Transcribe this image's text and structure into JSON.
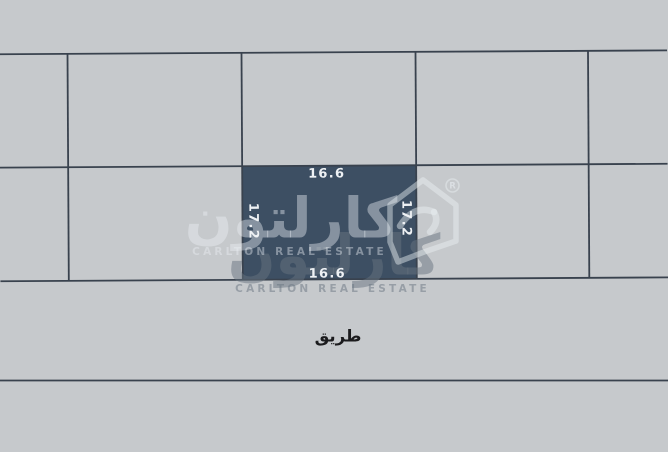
{
  "diagram": {
    "plot": {
      "dim_top": "16.6",
      "dim_bottom": "16.6",
      "dim_left": "17.2",
      "dim_right": "17.2"
    },
    "road_label": "طريق"
  },
  "watermark": {
    "arabic": "كارلتون",
    "latin": "CARLTON REAL ESTATE",
    "registered": "R"
  },
  "colors": {
    "background": "#c6c9cc",
    "plot_fill": "#3d4f63",
    "grid_line": "#39424e",
    "dimension_text": "#eef1f4",
    "road_text": "#1b1b1d",
    "watermark_front": "rgba(236,241,245,0.42)",
    "watermark_shadow": "rgba(104,115,127,0.50)"
  }
}
